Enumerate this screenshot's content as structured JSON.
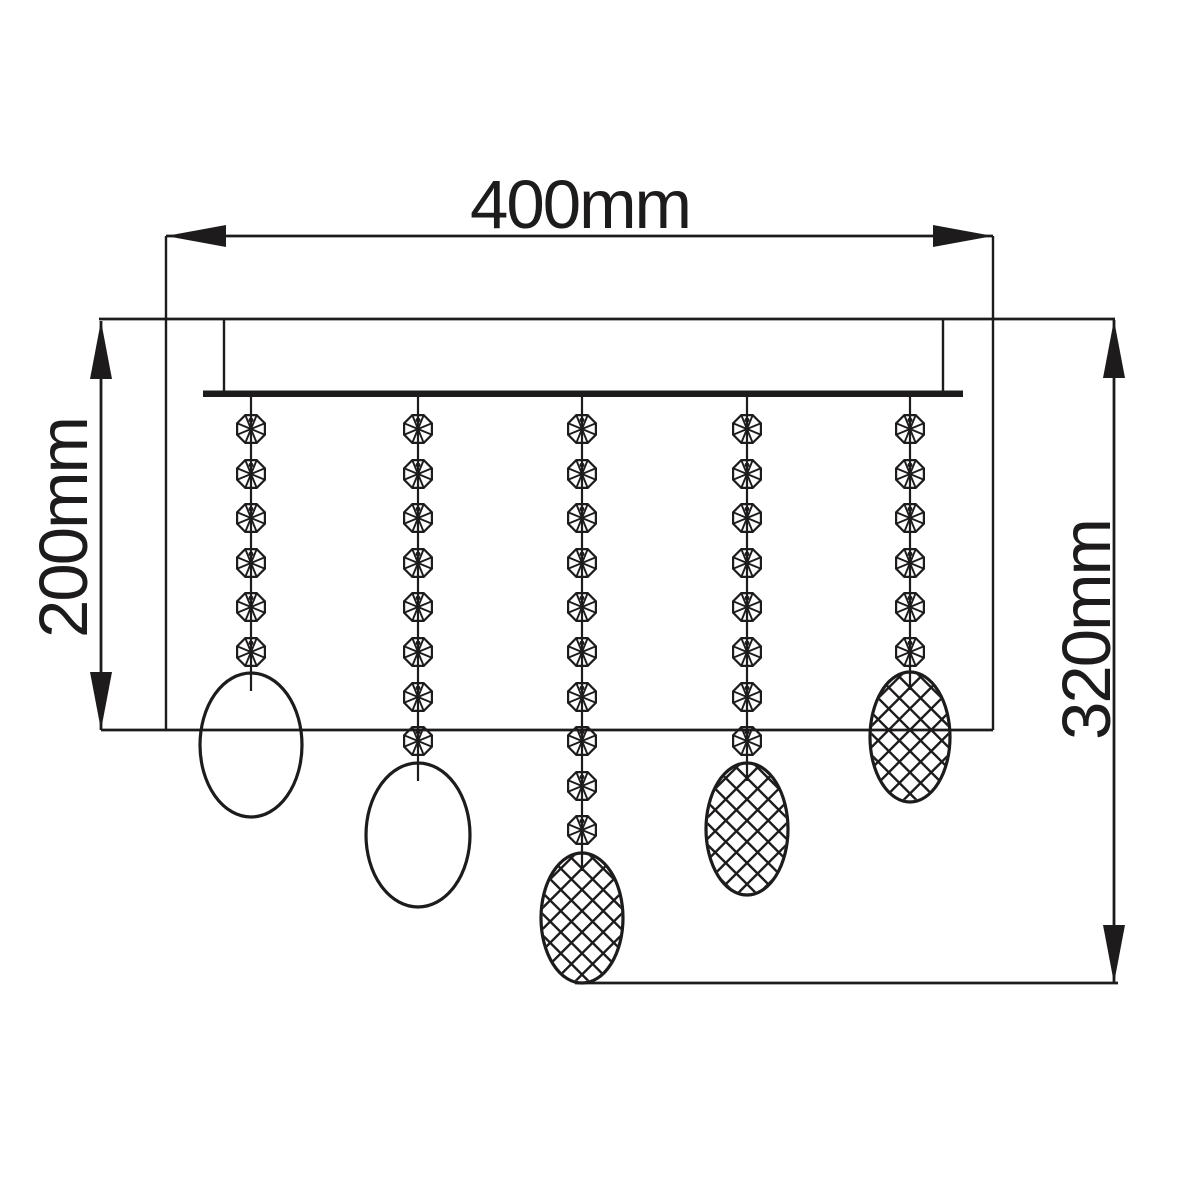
{
  "title": "Ceiling crystal light fixture dimension drawing",
  "colors": {
    "line": "#1d1b1b",
    "background": "#ffffff"
  },
  "dimensions": {
    "width": {
      "label": "400mm",
      "value_mm": 400
    },
    "drop_left": {
      "label": "200mm",
      "value_mm": 200
    },
    "drop_right": {
      "label": "320mm",
      "value_mm": 320
    }
  },
  "drawing": {
    "ceiling_line": {
      "x1": 99,
      "x2": 1115,
      "y": 319
    },
    "canopy": {
      "left": 224,
      "right": 943,
      "top": 319,
      "bottom": 391
    },
    "bar": {
      "x1": 203,
      "x2": 963,
      "top": 390.5,
      "bottom": 397
    },
    "dim_width": {
      "y": 236,
      "x1": 166,
      "x2": 993,
      "label_x": 580,
      "label_y": 228
    },
    "dim_left": {
      "x": 101,
      "y1": 321,
      "y2": 730,
      "label_x": 87,
      "label_y": 528
    },
    "dim_right": {
      "x": 1114,
      "y1": 320,
      "y2": 983,
      "label_x": 1110,
      "label_y": 630
    },
    "baseline_mid": {
      "x1": 101,
      "x2": 993,
      "y": 730
    },
    "baseline_bottom": {
      "x1": 575,
      "x2": 1118,
      "y": 983
    },
    "bead": {
      "radius": 15,
      "first_y": 429,
      "spacing": 44.6,
      "hole_dy": -9,
      "hole_r": 2.4
    },
    "hatch_spacing": 15,
    "strands": [
      {
        "x": 251,
        "bead_count": 6,
        "pendant": {
          "cy": 745,
          "rx": 51,
          "ry": 72,
          "hatched": false
        }
      },
      {
        "x": 418,
        "bead_count": 8,
        "pendant": {
          "cy": 835,
          "rx": 52,
          "ry": 72,
          "hatched": false
        }
      },
      {
        "x": 582,
        "bead_count": 10,
        "pendant": {
          "cy": 918,
          "rx": 41,
          "ry": 65,
          "hatched": true
        }
      },
      {
        "x": 747,
        "bead_count": 8,
        "pendant": {
          "cy": 829,
          "rx": 41,
          "ry": 66,
          "hatched": true
        }
      },
      {
        "x": 910,
        "bead_count": 6,
        "pendant": {
          "cy": 737,
          "rx": 40,
          "ry": 65,
          "hatched": true
        }
      }
    ]
  }
}
